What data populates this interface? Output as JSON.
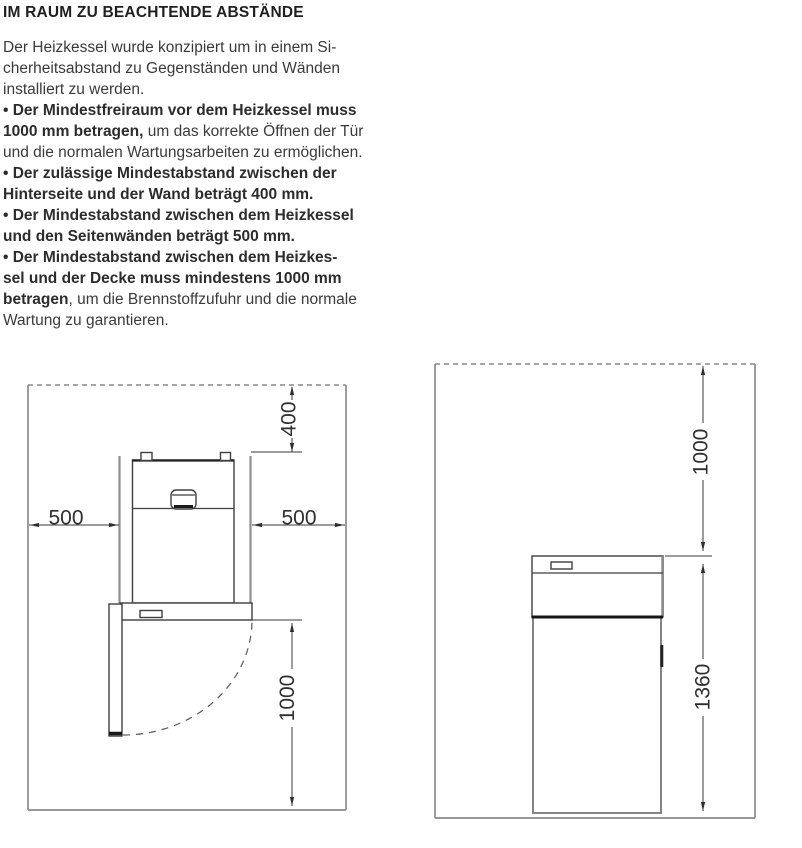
{
  "page": {
    "title": "IM RAUM ZU BEACHTENDE ABSTÄNDE",
    "body_lines": [
      [
        {
          "t": "Der Heizkessel wurde konzipiert um in einem Si-",
          "b": false
        }
      ],
      [
        {
          "t": "cherheitsabstand zu Gegenständen und Wänden",
          "b": false
        }
      ],
      [
        {
          "t": "installiert zu werden.",
          "b": false
        }
      ],
      [
        {
          "t": "• Der Mindestfreiraum vor dem Heizkessel muss",
          "b": true
        }
      ],
      [
        {
          "t": "1000 mm betragen,",
          "b": true
        },
        {
          "t": " um das korrekte Öffnen der Tür",
          "b": false
        }
      ],
      [
        {
          "t": "und die normalen Wartungsarbeiten zu ermöglichen.",
          "b": false
        }
      ],
      [
        {
          "t": "• Der zulässige Mindestabstand zwischen der",
          "b": true
        }
      ],
      [
        {
          "t": "Hinterseite und der Wand beträgt 400 mm.",
          "b": true
        }
      ],
      [
        {
          "t": "• Der Mindestabstand zwischen dem Heizkessel",
          "b": true
        }
      ],
      [
        {
          "t": "und den Seitenwänden beträgt 500 mm.",
          "b": true
        }
      ],
      [
        {
          "t": "• Der Mindestabstand zwischen dem Heizkes-",
          "b": true
        }
      ],
      [
        {
          "t": "sel und der Decke muss mindestens 1000 mm",
          "b": true
        }
      ],
      [
        {
          "t": "betragen",
          "b": true
        },
        {
          "t": ", um die Brennstoffzufuhr und die normale",
          "b": false
        }
      ],
      [
        {
          "t": "Wartung zu garantieren.",
          "b": false
        }
      ]
    ]
  },
  "diagrams": {
    "top_view": {
      "dim_rear_mm": "400",
      "dim_side_left_mm": "500",
      "dim_side_right_mm": "500",
      "dim_front_mm": "1000"
    },
    "side_view": {
      "dim_ceiling_mm": "1000",
      "dim_boiler_height_mm": "1360"
    }
  },
  "colors": {
    "ink": "#2f2f2f",
    "wall_line": "#8a8a8a",
    "drawing_line": "#3f3f3f"
  }
}
